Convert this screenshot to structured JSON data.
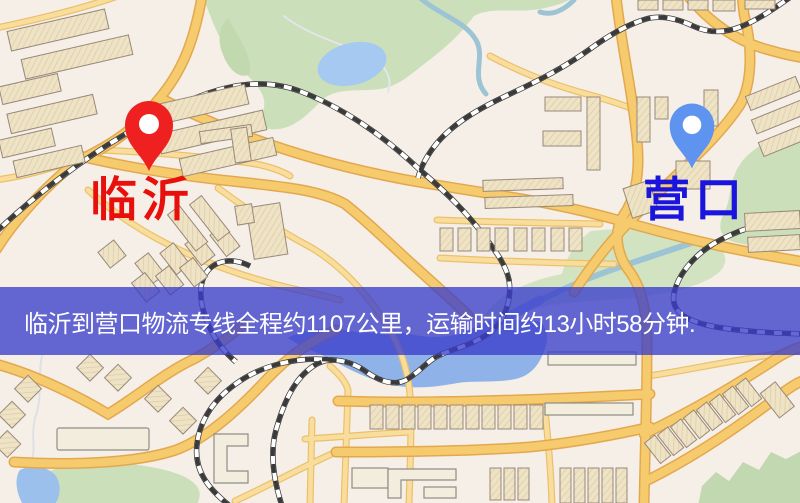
{
  "banner": {
    "text": "临沂到营口物流专线全程约1107公里，运输时间约13小时58分钟.",
    "background": "rgba(58,62,202,0.78)",
    "text_color": "#ffffff"
  },
  "markers": {
    "origin": {
      "label": "临沂",
      "label_color": "#e8100c",
      "pin_color": "#ee2020"
    },
    "destination": {
      "label": "营口",
      "label_color": "#1a14dd",
      "pin_color": "#5e93f0"
    }
  },
  "map_colors": {
    "background": "#f6efe7",
    "road_major": "#f6cb6e",
    "road_minor": "#f9dd9c",
    "park": "#cbdfba",
    "water": "#a5c9f0",
    "railway": "#3a3a3a",
    "building": "#efe3c5"
  }
}
